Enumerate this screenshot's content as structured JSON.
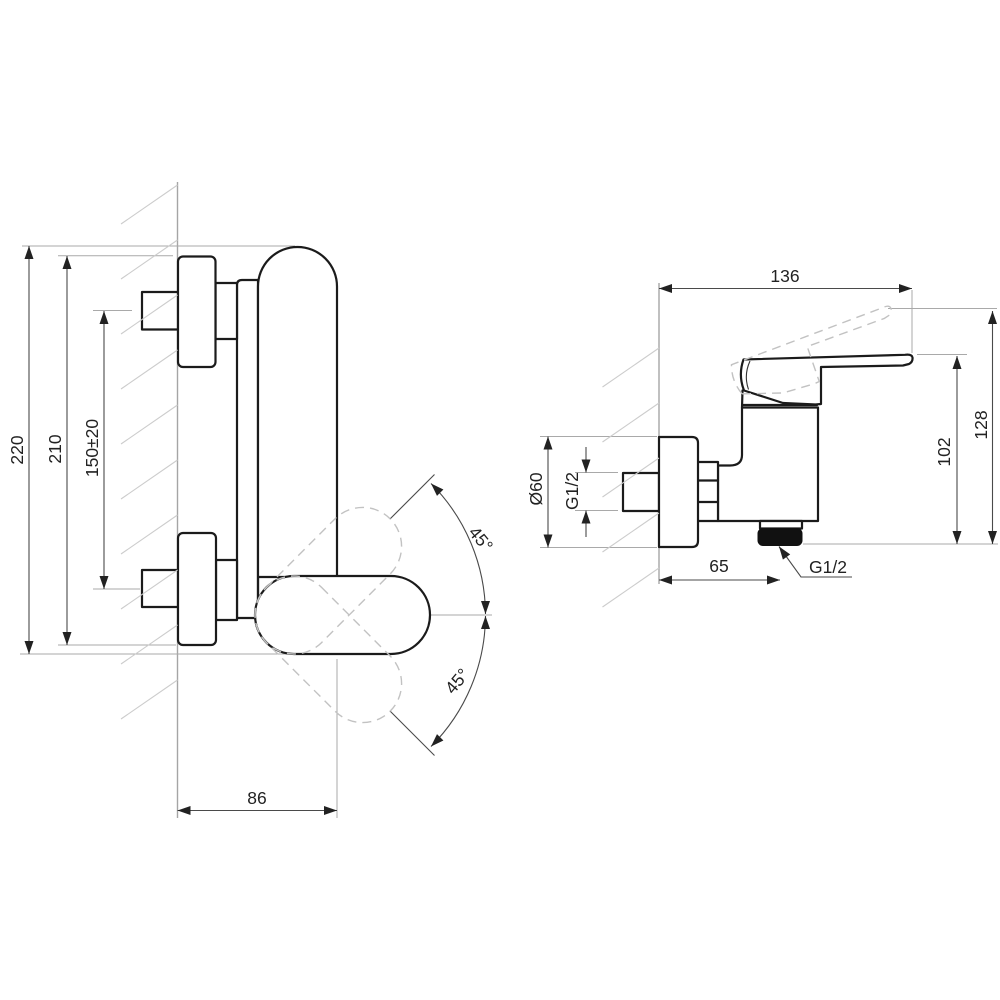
{
  "drawing": {
    "type": "technical-dimension-drawing",
    "subject": "wall-mounted single-lever shower mixer, front view and side view",
    "colors": {
      "outline": "#1b1b1b",
      "dimension": "#4a4a4a",
      "extension": "#a9a9a9",
      "hatch": "#cccccc",
      "phantom_dashed": "#c2c2c2",
      "outlet_nut": "#111111",
      "background": "#ffffff"
    },
    "views": {
      "front": {
        "name": "front view",
        "dimensions": {
          "height_overall": "220",
          "height_escutcheon": "210",
          "inlet_centers": "150±20",
          "depth_from_wall": "86",
          "lever_angle_up": "45°",
          "lever_angle_down": "45°"
        }
      },
      "side": {
        "name": "side view",
        "dimensions": {
          "width_overall": "136",
          "height_overall": "128",
          "height_body": "102",
          "flange_diameter": "Ø60",
          "inlet_thread": "G1/2",
          "outlet_offset": "65",
          "outlet_thread": "G1/2"
        }
      }
    }
  }
}
